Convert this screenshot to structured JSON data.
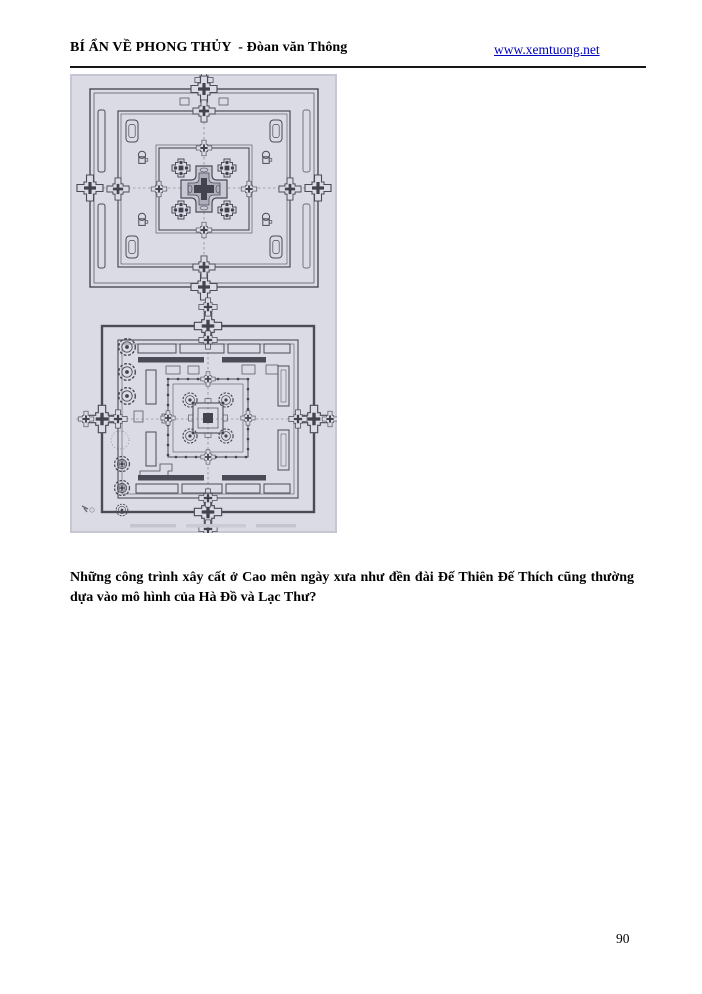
{
  "header": {
    "title": "BÍ ẨN VỀ PHONG THỦY  - Đòan văn Thông",
    "link": "www.xemtuong.net"
  },
  "figure": {
    "icon": "temple-floor-plans-scan",
    "background_color": "#dadbe4",
    "ink_color": "#4b4b57"
  },
  "caption": {
    "text": "Những công trình xây cất ở Cao mên ngày xưa như đền đài Đế Thiên Đế Thích cũng thường dựa vào mô hình của Hà Đồ và Lạc Thư?"
  },
  "footer": {
    "page_number": "90"
  },
  "colors": {
    "link": "#0000bf",
    "text": "#000000",
    "rule": "#161616"
  }
}
